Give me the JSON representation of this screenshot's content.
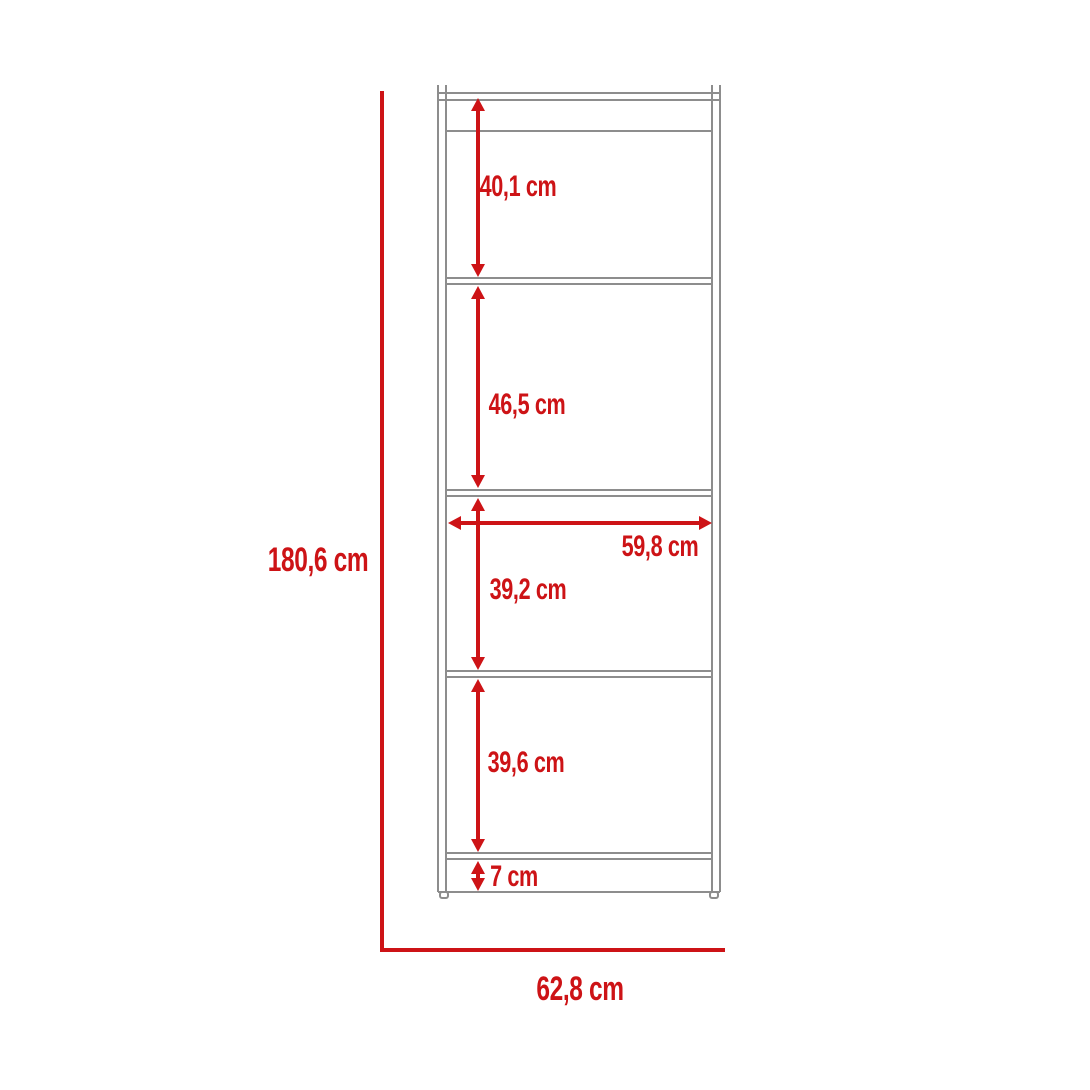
{
  "diagram": {
    "type": "furniture-dimension-drawing",
    "subject": "5-tier bookcase front elevation",
    "dimensions": {
      "total_height": "180,6 cm",
      "total_width": "62,8 cm",
      "inner_width": "59,8 cm",
      "section_1_height": "40,1 cm",
      "section_2_height": "46,5 cm",
      "section_3_height": "39,2 cm",
      "section_4_height": "39,6 cm",
      "base_height": "7 cm"
    },
    "colors": {
      "dimension-red": "#cd1316",
      "line-gray": "#8d8d8d",
      "bg": "#ffffff"
    }
  }
}
